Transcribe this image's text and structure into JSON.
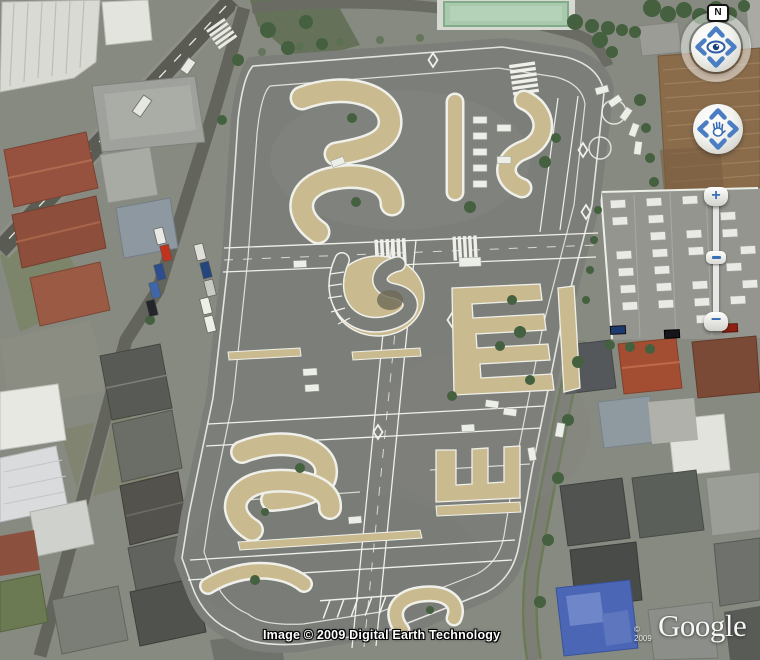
{
  "app": "google-earth-satellite-view",
  "map": {
    "attribution": "Image © 2009 Digital Earth Technology",
    "logo": {
      "text": "Google",
      "copyright": "© 2009"
    }
  },
  "nav": {
    "north_label": "N",
    "zoom_in_label": "+",
    "zoom_out_label": "−"
  },
  "scene": {
    "description": "aerial view of a driving-school practice course surrounded by houses, a dirt field and a car lot",
    "colors": {
      "asphalt": "#7c7e7a",
      "island_tan": "#c9ba90",
      "marking_white": "#f0f0ea",
      "dirt_field": "#8a6c4b",
      "green_roof": "#a9c9ad",
      "control_blue": "#4a7dc2"
    }
  }
}
